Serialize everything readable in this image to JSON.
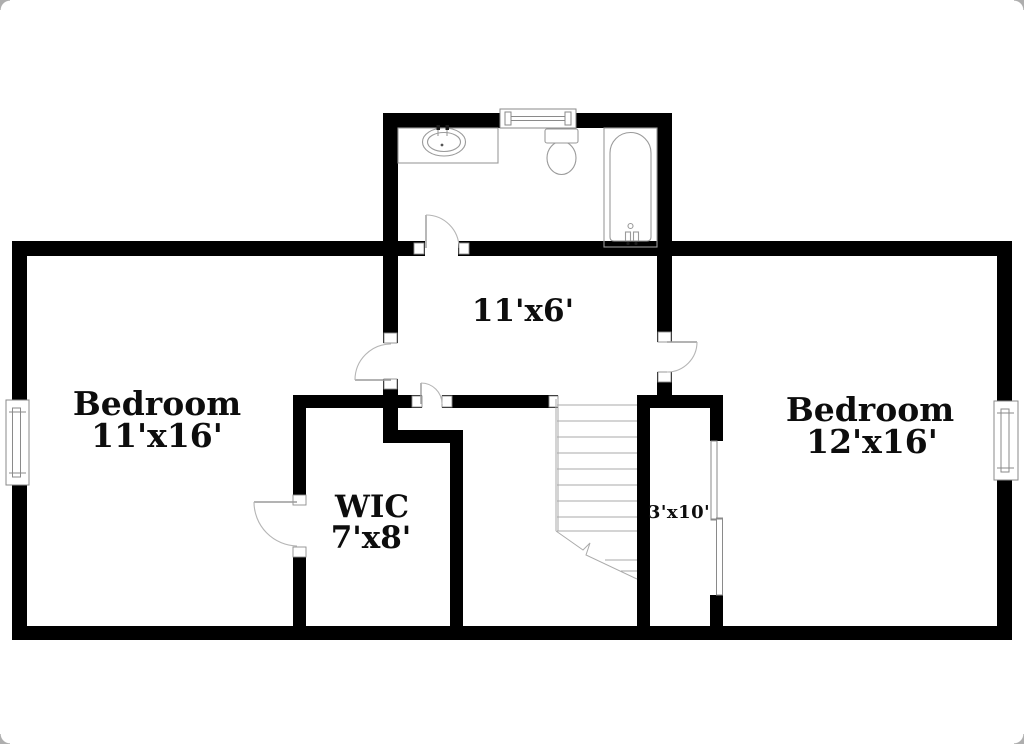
{
  "floorplan": {
    "background": "#ffffff",
    "wall_color": "#000000",
    "fixture_line_color": "#9a9a9a",
    "text_color": "#0d0d0d",
    "rooms": {
      "bedroom_left": {
        "name": "Bedroom",
        "dims": "11'x16'"
      },
      "bedroom_right": {
        "name": "Bedroom",
        "dims": "12'x16'"
      },
      "wic": {
        "name": "WIC",
        "dims": "7'x8'"
      },
      "hallway": {
        "dims": "11'x6'"
      },
      "closet": {
        "dims": "3'x10'"
      }
    },
    "fixtures": {
      "bathroom": [
        "vanity-sink",
        "toilet",
        "bathtub"
      ],
      "circulation": [
        "staircase"
      ],
      "openings": [
        "swing-doors",
        "windows",
        "sliding-closet-door"
      ]
    }
  }
}
